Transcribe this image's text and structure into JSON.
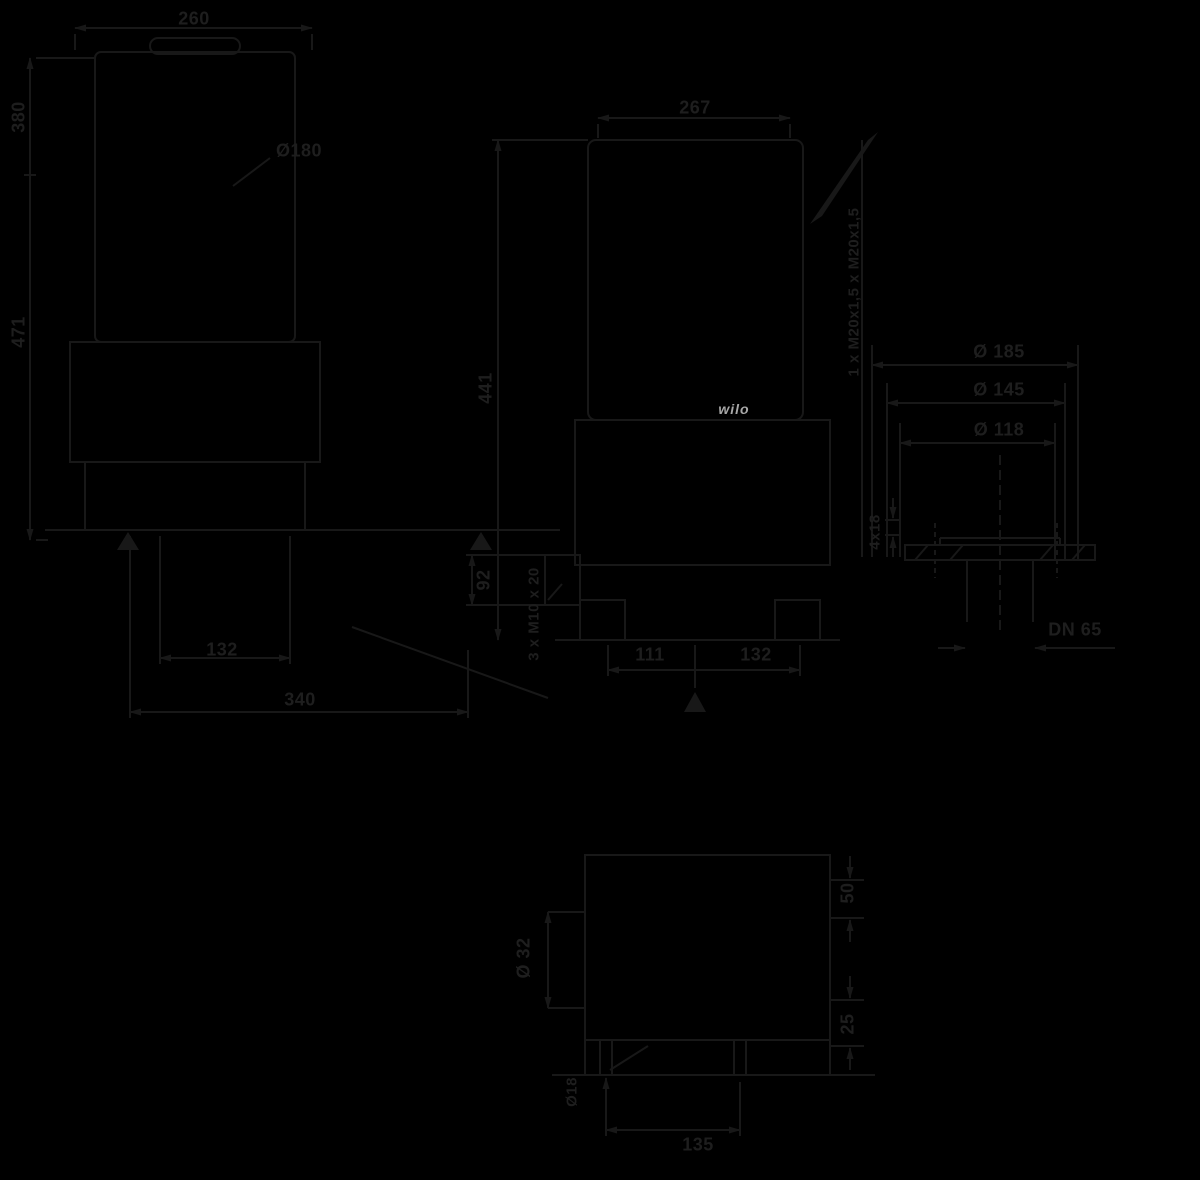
{
  "title": "pump-dimension-drawing",
  "colors": {
    "background": "#000000",
    "line": "#181818",
    "text": "#1e1e1e",
    "logo": "#a8a8a8"
  },
  "front_view": {
    "width_top": "260",
    "motor_dia": "Ø180",
    "height_upper": "380",
    "height_total": "471",
    "base_width_inner": "132",
    "base_width_outer": "340"
  },
  "side_view": {
    "depth_top": "267",
    "height_discharge": "441",
    "flange_offset": "92",
    "tapped_holes": "3 x M10 x 20",
    "base_front": "111",
    "base_rear": "132",
    "logo": "wilo",
    "cable_glands": "1 x M20x1,5 x M20x1,5"
  },
  "flange_detail": {
    "outer_dia": "Ø 185",
    "bolt_circle_dia": "Ø 145",
    "raised_face_dia": "Ø 118",
    "bolt_holes": "4x18",
    "nominal_dia": "DN 65"
  },
  "base_detail": {
    "port_dia": "Ø 32",
    "hole_dia": "Ø18",
    "hole_spacing": "135",
    "offset_top": "50",
    "offset_bottom": "25"
  }
}
